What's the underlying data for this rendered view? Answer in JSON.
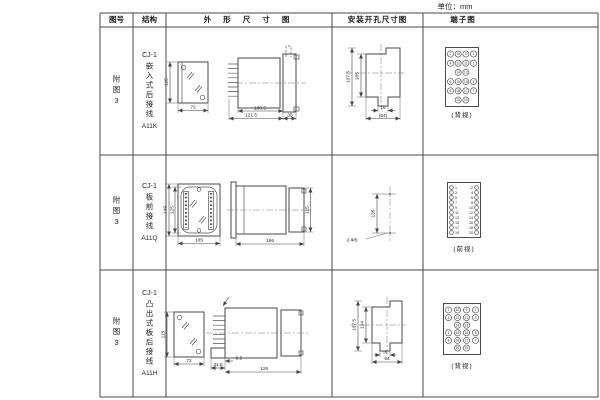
{
  "unit_label": "单位：mm",
  "headers": {
    "fig": "图号",
    "structure": "结构",
    "outline": "外 形 尺 寸 图",
    "mounting": "安装开孔尺寸图",
    "terminal": "端子图"
  },
  "rows": [
    {
      "fig": "附图3",
      "model": "CJ-1",
      "mount_type": "嵌入式后接线",
      "code": "A11K",
      "outline_dims": {
        "height": "115",
        "width": "72",
        "depth": "100.5",
        "total": "121.5",
        "front": "35"
      },
      "mounting_dims": {
        "outer_h": "107.5",
        "inner_h": "105",
        "tab_w": "16",
        "width": "(64)"
      },
      "terminal": {
        "view_label": "(背视)",
        "type": "staggered",
        "rows": [
          [
            2,
            10,
            9,
            1
          ],
          [
            4,
            12,
            11,
            3
          ],
          [
            null,
            14,
            13,
            null
          ],
          [
            6,
            16,
            15,
            5
          ],
          [
            8,
            18,
            17,
            7
          ],
          [
            null,
            20,
            19,
            null
          ]
        ]
      }
    },
    {
      "fig": "附图3",
      "model": "CJ-1",
      "mount_type": "板前接线",
      "code": "A11Q",
      "outline_dims": {
        "outer_h": "149",
        "inner_h": "125",
        "width": "105",
        "depth": "156",
        "height": "115"
      },
      "mounting_dims": {
        "spacing": "135",
        "holes": "2-Φ5"
      },
      "terminal": {
        "view_label": "(前视)",
        "type": "two-column",
        "left": [
          1,
          3,
          5,
          7,
          9,
          11,
          13,
          15,
          17,
          19
        ],
        "right": [
          2,
          4,
          6,
          8,
          10,
          12,
          14,
          16,
          18,
          20
        ]
      }
    },
    {
      "fig": "附图3",
      "model": "CJ-1",
      "mount_type": "凸出式板后接线",
      "code": "A11H",
      "outline_dims": {
        "height": "115",
        "width": "72",
        "front": "31.5",
        "offset": "9.5",
        "depth": "126"
      },
      "mounting_dims": {
        "outer_h": "107.5",
        "inner_h": "104",
        "tab_w": "16",
        "width": "64"
      },
      "terminal": {
        "view_label": "(背视)",
        "type": "staggered",
        "rows": [
          [
            2,
            10,
            9,
            1
          ],
          [
            4,
            12,
            11,
            3
          ],
          [
            null,
            14,
            13,
            null
          ],
          [
            6,
            16,
            15,
            5
          ],
          [
            8,
            18,
            17,
            7
          ],
          [
            null,
            20,
            19,
            null
          ]
        ]
      }
    }
  ]
}
